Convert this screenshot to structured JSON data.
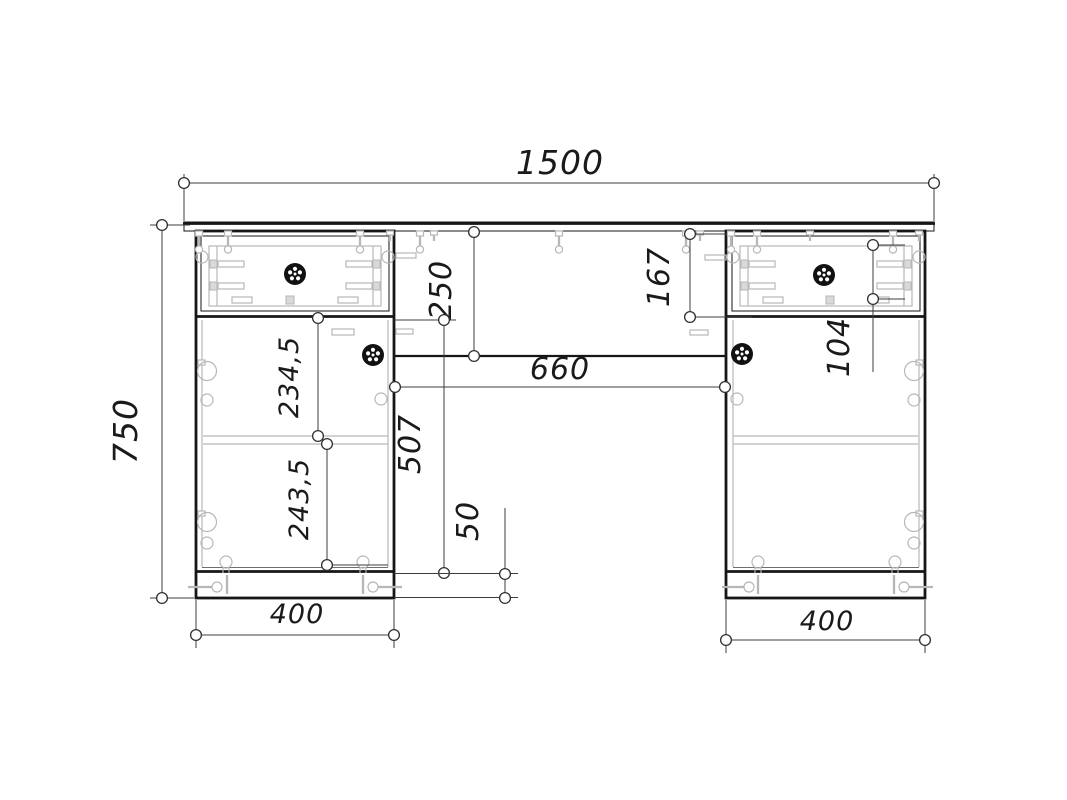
{
  "drawing": {
    "labels": {
      "overall_width": "1500",
      "overall_height": "750",
      "modesty_panel_height": "250",
      "knee_hole_width": "660",
      "drawer_front_height": "167",
      "drawer_box_height": "104",
      "upper_compartment_height": "234,5",
      "lower_compartment_height": "243,5",
      "door_section_height": "507",
      "plinth_height": "50",
      "left_pedestal_width": "400",
      "right_pedestal_width": "400"
    },
    "icons": {
      "knob": "round-knob-icon",
      "hinge": "cup-hinge-icon",
      "screw": "screw-icon",
      "dimension_arrow": "circle-arrowhead-icon"
    },
    "colors": {
      "structure_line": "#161616",
      "hardware_line": "#b7b7b7",
      "dimension_line": "#3c3c3c",
      "background": "#ffffff"
    }
  }
}
